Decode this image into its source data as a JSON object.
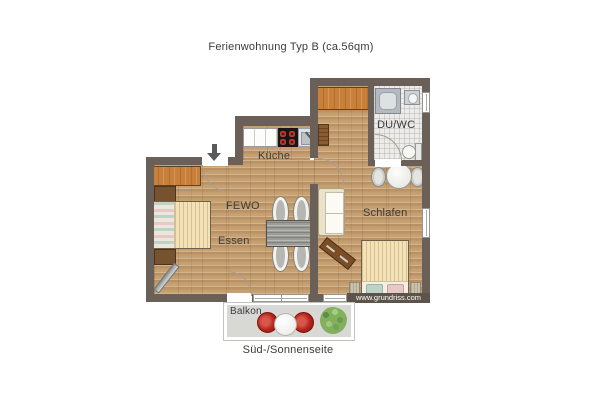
{
  "title": "Ferienwohnung Typ B (ca.56qm)",
  "labels": {
    "kitchen": "Küche",
    "living": "FEWO",
    "dining": "Essen",
    "bedroom": "Schlafen",
    "bathroom": "DU/WC",
    "balcony": "Balkon",
    "orientation": "Süd-/Sonnenseite",
    "watermark": "www.grundriss.com"
  },
  "colors": {
    "wall": "#6b6058",
    "wood_floor": "#c8a172",
    "tile_floor": "#edecea",
    "balcony_floor": "#d8d8d4",
    "wardrobe_wood": "#c8803a",
    "chair_red": "#b2241c",
    "plant_green": "#83b05f",
    "text": "#3b3b3b"
  }
}
